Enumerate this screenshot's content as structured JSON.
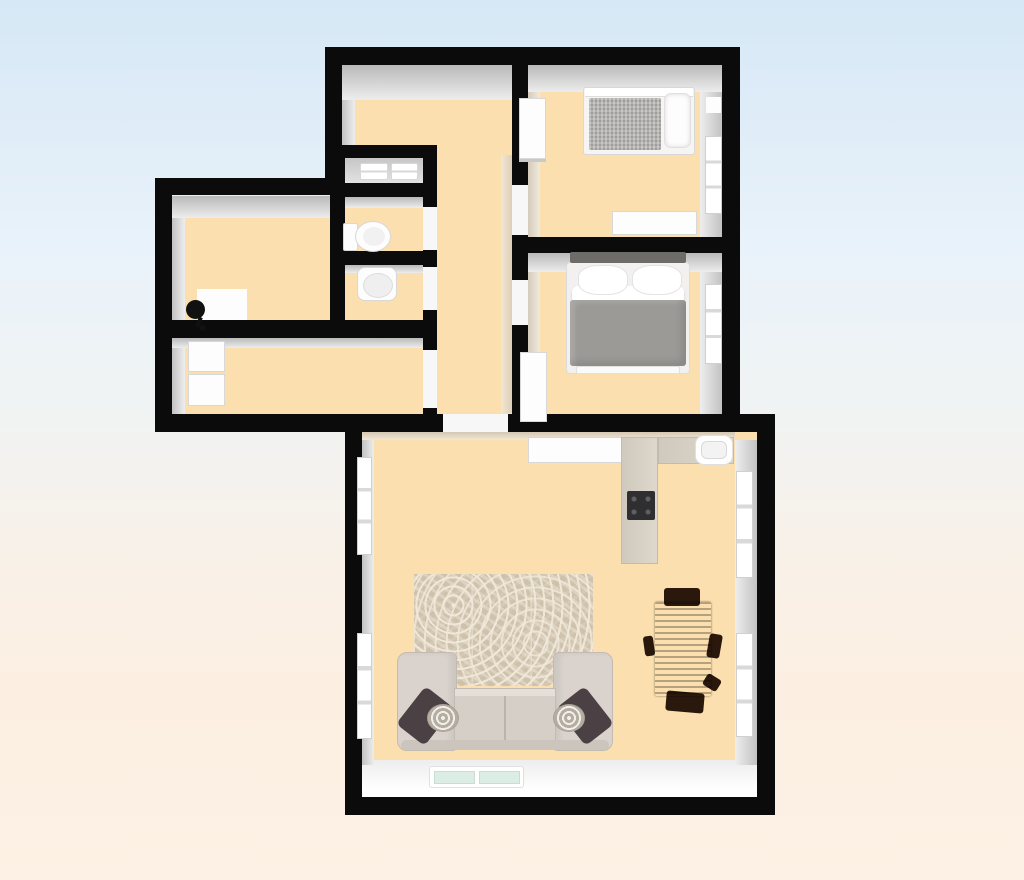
{
  "scene": {
    "type": "3d-floorplan-top-down-render",
    "title": "apartment-floor-plan",
    "background": {
      "sky_top": "#d6e8f6",
      "warm_bottom": "#fdf1e5"
    },
    "palette": {
      "wall": "#0b0b0b",
      "floor": "#fcdfae",
      "wall_inner_face": "#c6c6c6",
      "furniture_white": "#fdfdfd",
      "counter": "#d5cfc4",
      "cooktop": "#2f2f31",
      "sofa": "#d8d1ca",
      "sofa_pillow_dark": "#4b4144",
      "rug": "#cfc2ad",
      "dining_table_wood": "#38221a",
      "bed_blanket_gray": "#9c9a97",
      "single_bed_mattress": "#b2b1af",
      "headboard_dark": "#6e6c69",
      "glass": "#dcede5"
    },
    "rooms": [
      {
        "name": "hall-corridor",
        "floor": "#fcdfae",
        "furniture": []
      },
      {
        "name": "bedroom-top-right",
        "furniture": [
          "single-bed",
          "pillow",
          "wardrobe",
          "dresser",
          "window"
        ]
      },
      {
        "name": "bedroom-middle-right",
        "furniture": [
          "double-bed",
          "two-pillows",
          "gray-blanket",
          "cabinet",
          "window"
        ]
      },
      {
        "name": "storage-closet",
        "floor": "#d9d9d9",
        "furniture": [
          "folded-linens-left",
          "folded-linens-right"
        ]
      },
      {
        "name": "wc",
        "furniture": [
          "toilet"
        ]
      },
      {
        "name": "bathroom",
        "furniture": [
          "washbasin"
        ]
      },
      {
        "name": "room-upper-left",
        "furniture": [
          "white-mat",
          "floor-lamp"
        ]
      },
      {
        "name": "room-lower-left",
        "furniture": [
          "fridge",
          "cabinet"
        ]
      },
      {
        "name": "living-room",
        "furniture": [
          "sideboard",
          "kitchen-counter-l",
          "cooktop",
          "kitchen-sink",
          "patterned-rug",
          "sectional-sofa",
          "dark-throw-pillows",
          "round-cushions",
          "dining-table",
          "dining-chairs",
          "left-windows",
          "right-windows",
          "bottom-glass-window"
        ]
      }
    ],
    "door_openings": [
      "corridor-to-living-room",
      "bedroom-top-right-door",
      "bedroom-middle-right-door",
      "wc-door",
      "bathroom-door",
      "room-lower-left-door"
    ]
  }
}
